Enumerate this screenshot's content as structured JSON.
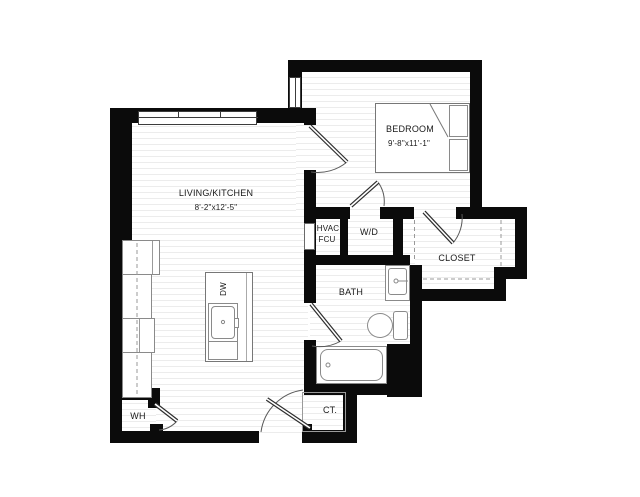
{
  "plan": {
    "rooms": {
      "living": {
        "label": "LIVING/KITCHEN",
        "dims": "8'-2\"x12'-5\""
      },
      "bedroom": {
        "label": "BEDROOM",
        "dims": "9'-8\"x11'-1\""
      },
      "bath": {
        "label": "BATH"
      },
      "closet": {
        "label": "CLOSET"
      },
      "laundry": {
        "label": "W/D"
      },
      "hvac": {
        "line1": "HVAC",
        "line2": "FCU"
      },
      "water_heater": {
        "label": "WH"
      },
      "coat_closet": {
        "label": "CT."
      },
      "dishwasher": {
        "label": "DW"
      }
    },
    "colors": {
      "wall": "#0b0b0b",
      "fixture_outline": "#8a8a8a",
      "floor_line": "#ececec",
      "text": "#1a1a1a"
    }
  }
}
